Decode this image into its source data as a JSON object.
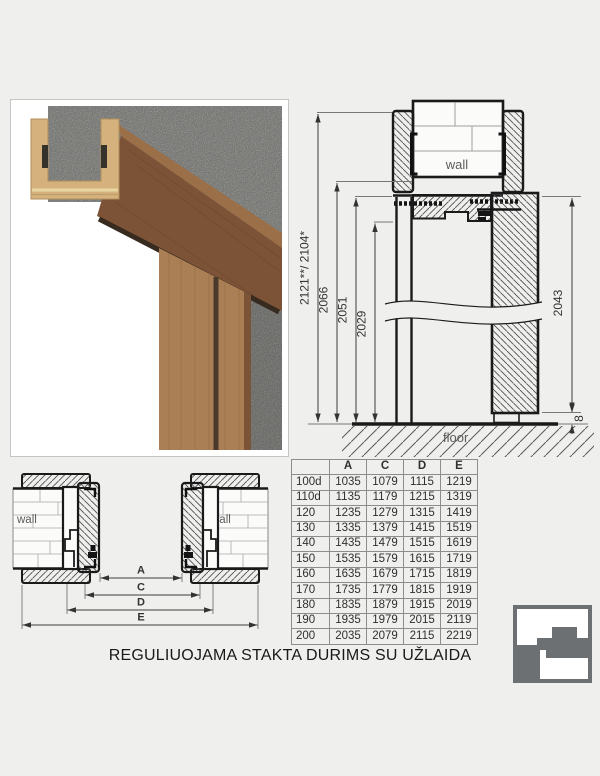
{
  "caption": "REGULIUOJAMA STAKTA DURIMS SU UŽLAIDA",
  "vertical_section": {
    "wall_label": "wall",
    "floor_label": "floor",
    "dim_overall": "2121**/ 2104*",
    "dim_2066": "2066",
    "dim_2051": "2051",
    "dim_2029": "2029",
    "dim_door_height": "2043",
    "dim_floor_gap": "8"
  },
  "horizontal_section": {
    "wall_label_left": "wall",
    "wall_label_right": "wall",
    "dim_a": "A",
    "dim_c": "C",
    "dim_d": "D",
    "dim_e": "E"
  },
  "table": {
    "headers": [
      "",
      "A",
      "C",
      "D",
      "E"
    ],
    "rows": [
      [
        "100d",
        "1035",
        "1079",
        "1115",
        "1219"
      ],
      [
        "110d",
        "1135",
        "1179",
        "1215",
        "1319"
      ],
      [
        "120",
        "1235",
        "1279",
        "1315",
        "1419"
      ],
      [
        "130",
        "1335",
        "1379",
        "1415",
        "1519"
      ],
      [
        "140",
        "1435",
        "1479",
        "1515",
        "1619"
      ],
      [
        "150",
        "1535",
        "1579",
        "1615",
        "1719"
      ],
      [
        "160",
        "1635",
        "1679",
        "1715",
        "1819"
      ],
      [
        "170",
        "1735",
        "1779",
        "1815",
        "1919"
      ],
      [
        "180",
        "1835",
        "1879",
        "1915",
        "2019"
      ],
      [
        "190",
        "1935",
        "1979",
        "2015",
        "2119"
      ],
      [
        "200",
        "2035",
        "2079",
        "2115",
        "2219"
      ]
    ]
  },
  "icons": {
    "brand_logo": "door-frame-profile-icon"
  },
  "colors": {
    "background": "#efefed",
    "line": "#1a1a1a",
    "wood_dark": "#7d5337",
    "wood_light": "#d5b27d",
    "logo_gray": "#6d7073"
  }
}
